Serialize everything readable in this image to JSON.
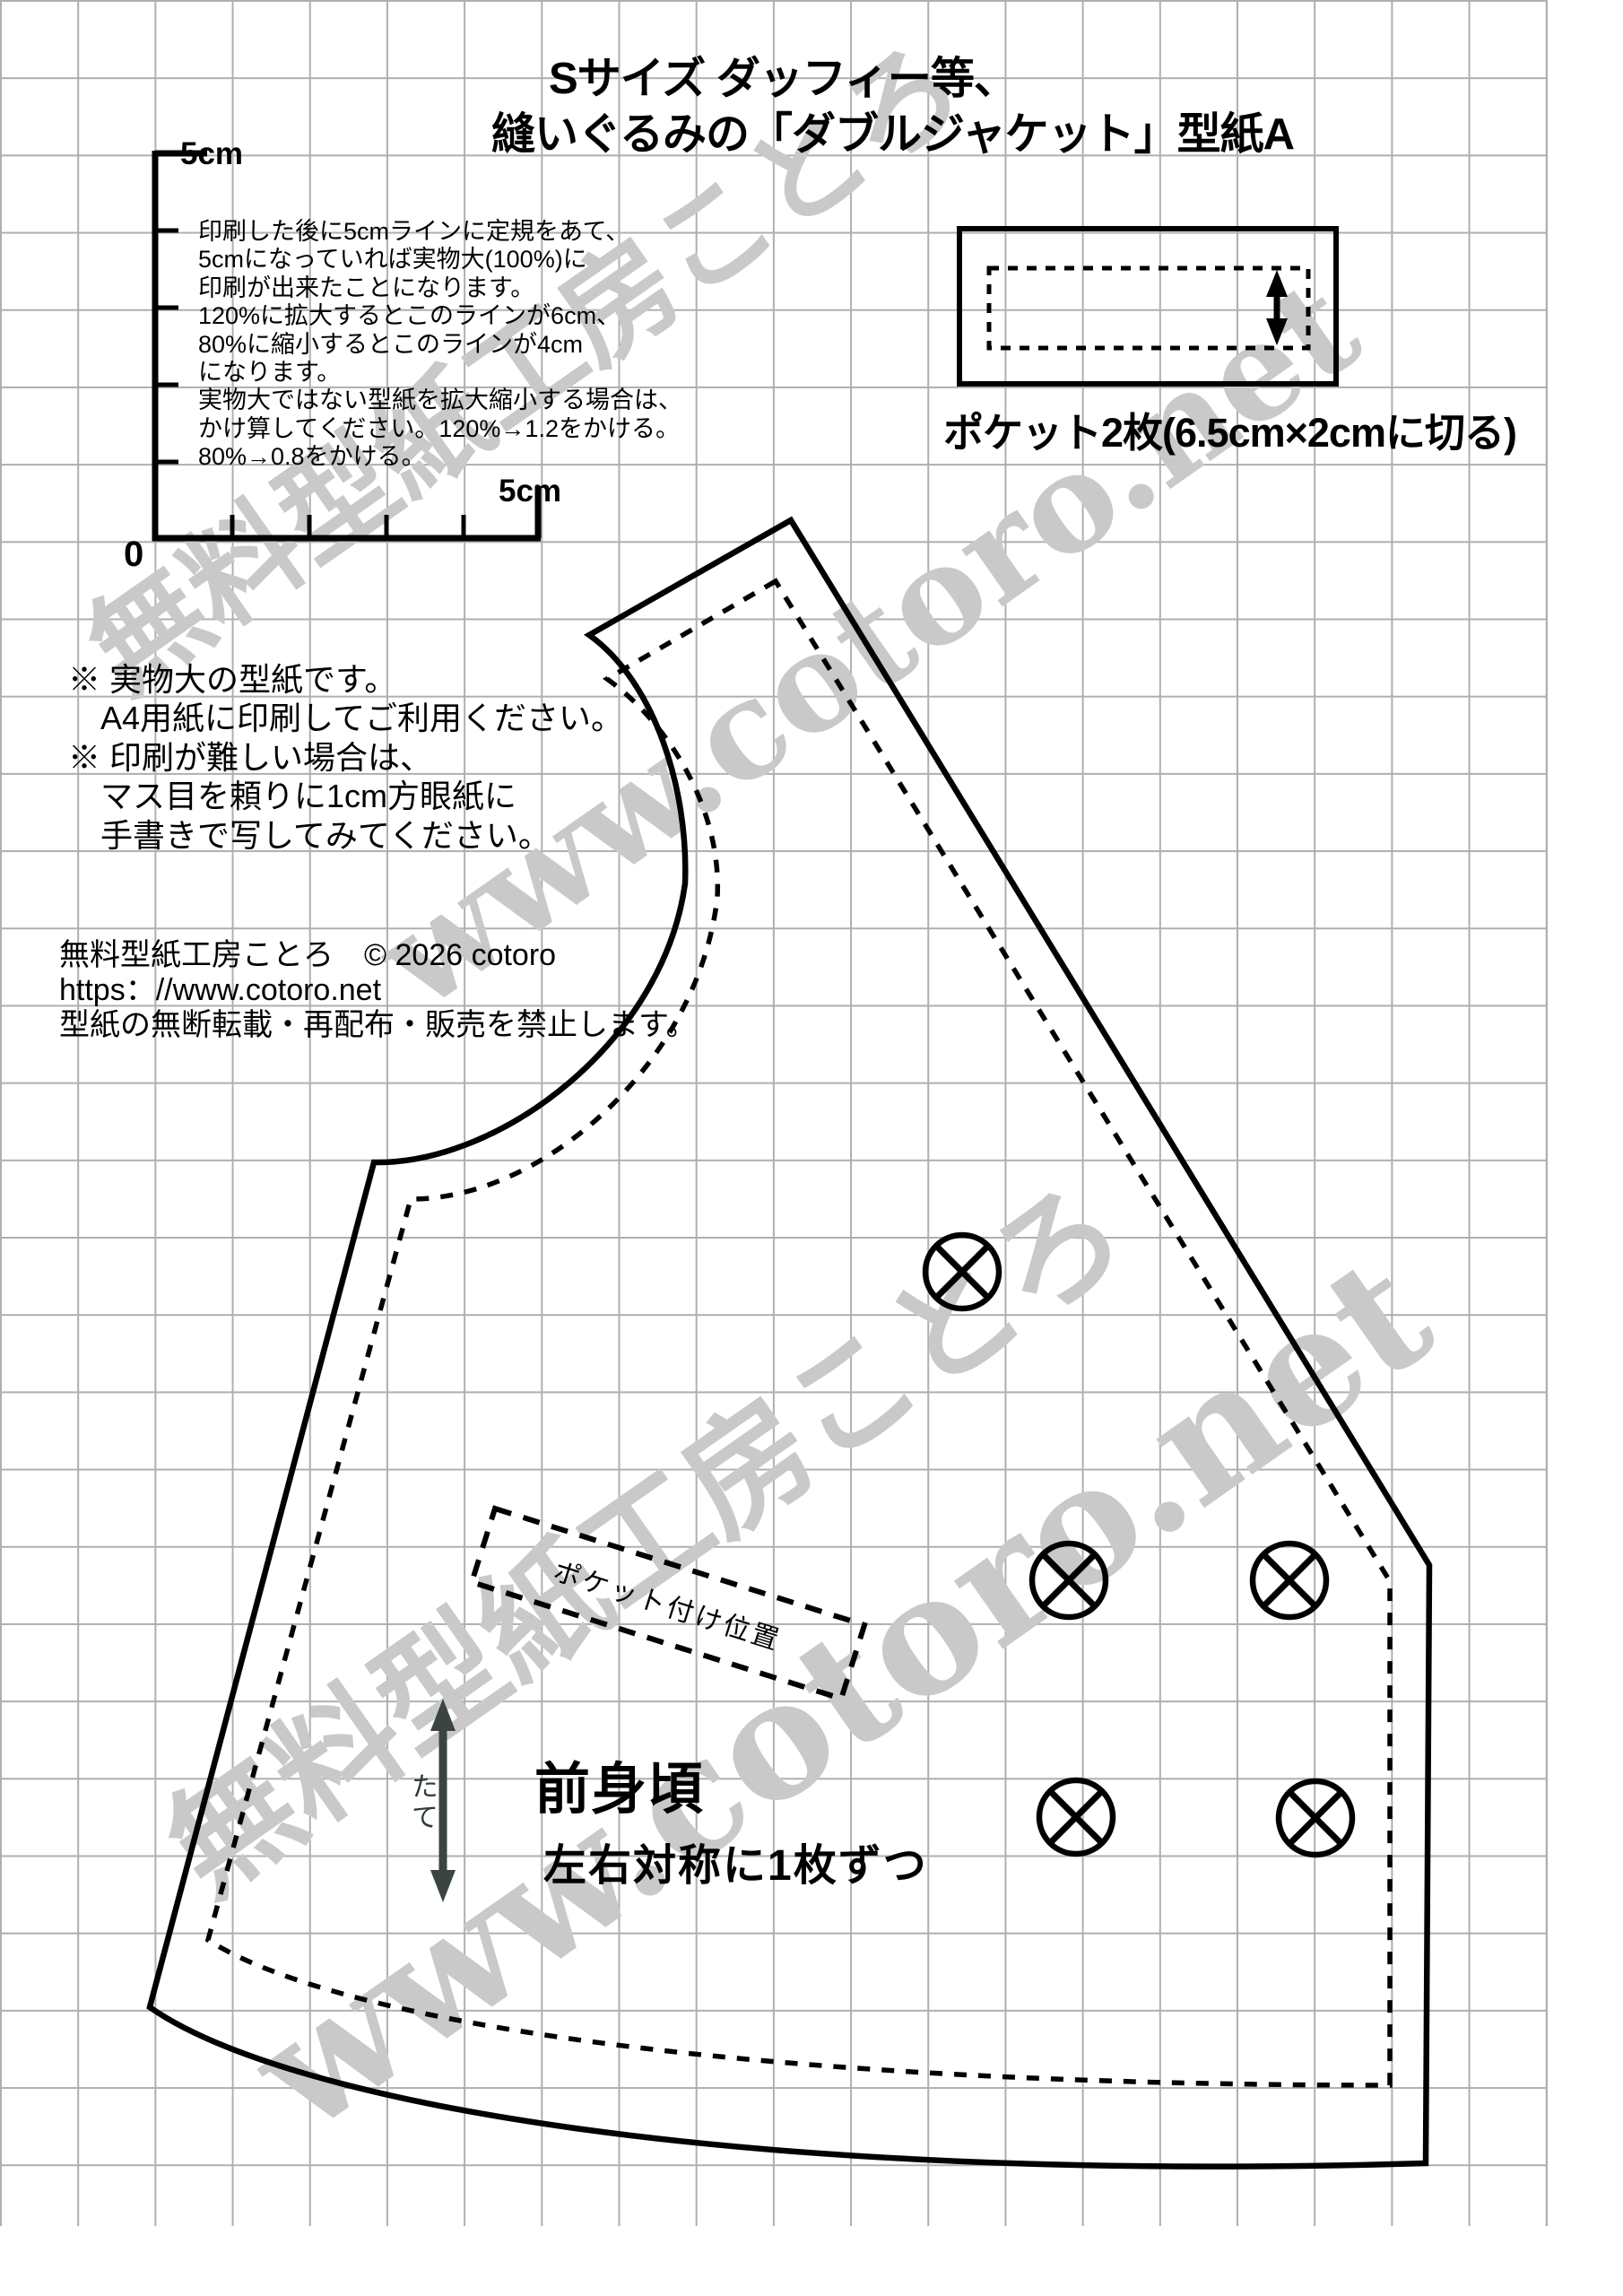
{
  "title": {
    "line1": "Sサイズ ダッフィー等、",
    "line2": "縫いぐるみの「ダブルジャケット」型紙A"
  },
  "scale_ruler": {
    "top_label": "5cm",
    "right_label": "5cm",
    "origin_label": "0"
  },
  "scale_instructions": [
    "印刷した後に5cmラインに定規をあて、",
    "5cmになっていれば実物大(100%)に",
    "印刷が出来たことになります。",
    "120%に拡大するとこのラインが6cm、",
    "80%に縮小するとこのラインが4cm",
    "になります。",
    "実物大ではない型紙を拡大縮小する場合は、",
    "かけ算してください。120%→1.2をかける。",
    "80%→0.8をかける。"
  ],
  "pocket_piece": {
    "label": "ポケット2枚(6.5cm×2cmに切る)"
  },
  "notes": [
    "※ 実物大の型紙です。",
    "　A4用紙に印刷してご利用ください。",
    "※ 印刷が難しい場合は、",
    "　マス目を頼りに1cm方眼紙に",
    "　手書きで写してみてください。"
  ],
  "copyright": {
    "line1": "無料型紙工房ことろ　© 2026 cotoro",
    "line2": "https：//www.cotoro.net",
    "line3": "型紙の無断転載・再配布・販売を禁止します。"
  },
  "pattern_piece": {
    "name": "前身頃",
    "cut_note": "左右対称に1枚ずつ",
    "pocket_position_label": "ポケット付け位置",
    "grain_label": "たて"
  },
  "watermarks": {
    "studio": "無料型紙工房ことろ",
    "url": "www.cotoro.net"
  },
  "colors": {
    "grid": "#aab0b6",
    "watermark": "#c9c9c9",
    "ink": "#000000",
    "grain_arrow": "#3b4343"
  }
}
